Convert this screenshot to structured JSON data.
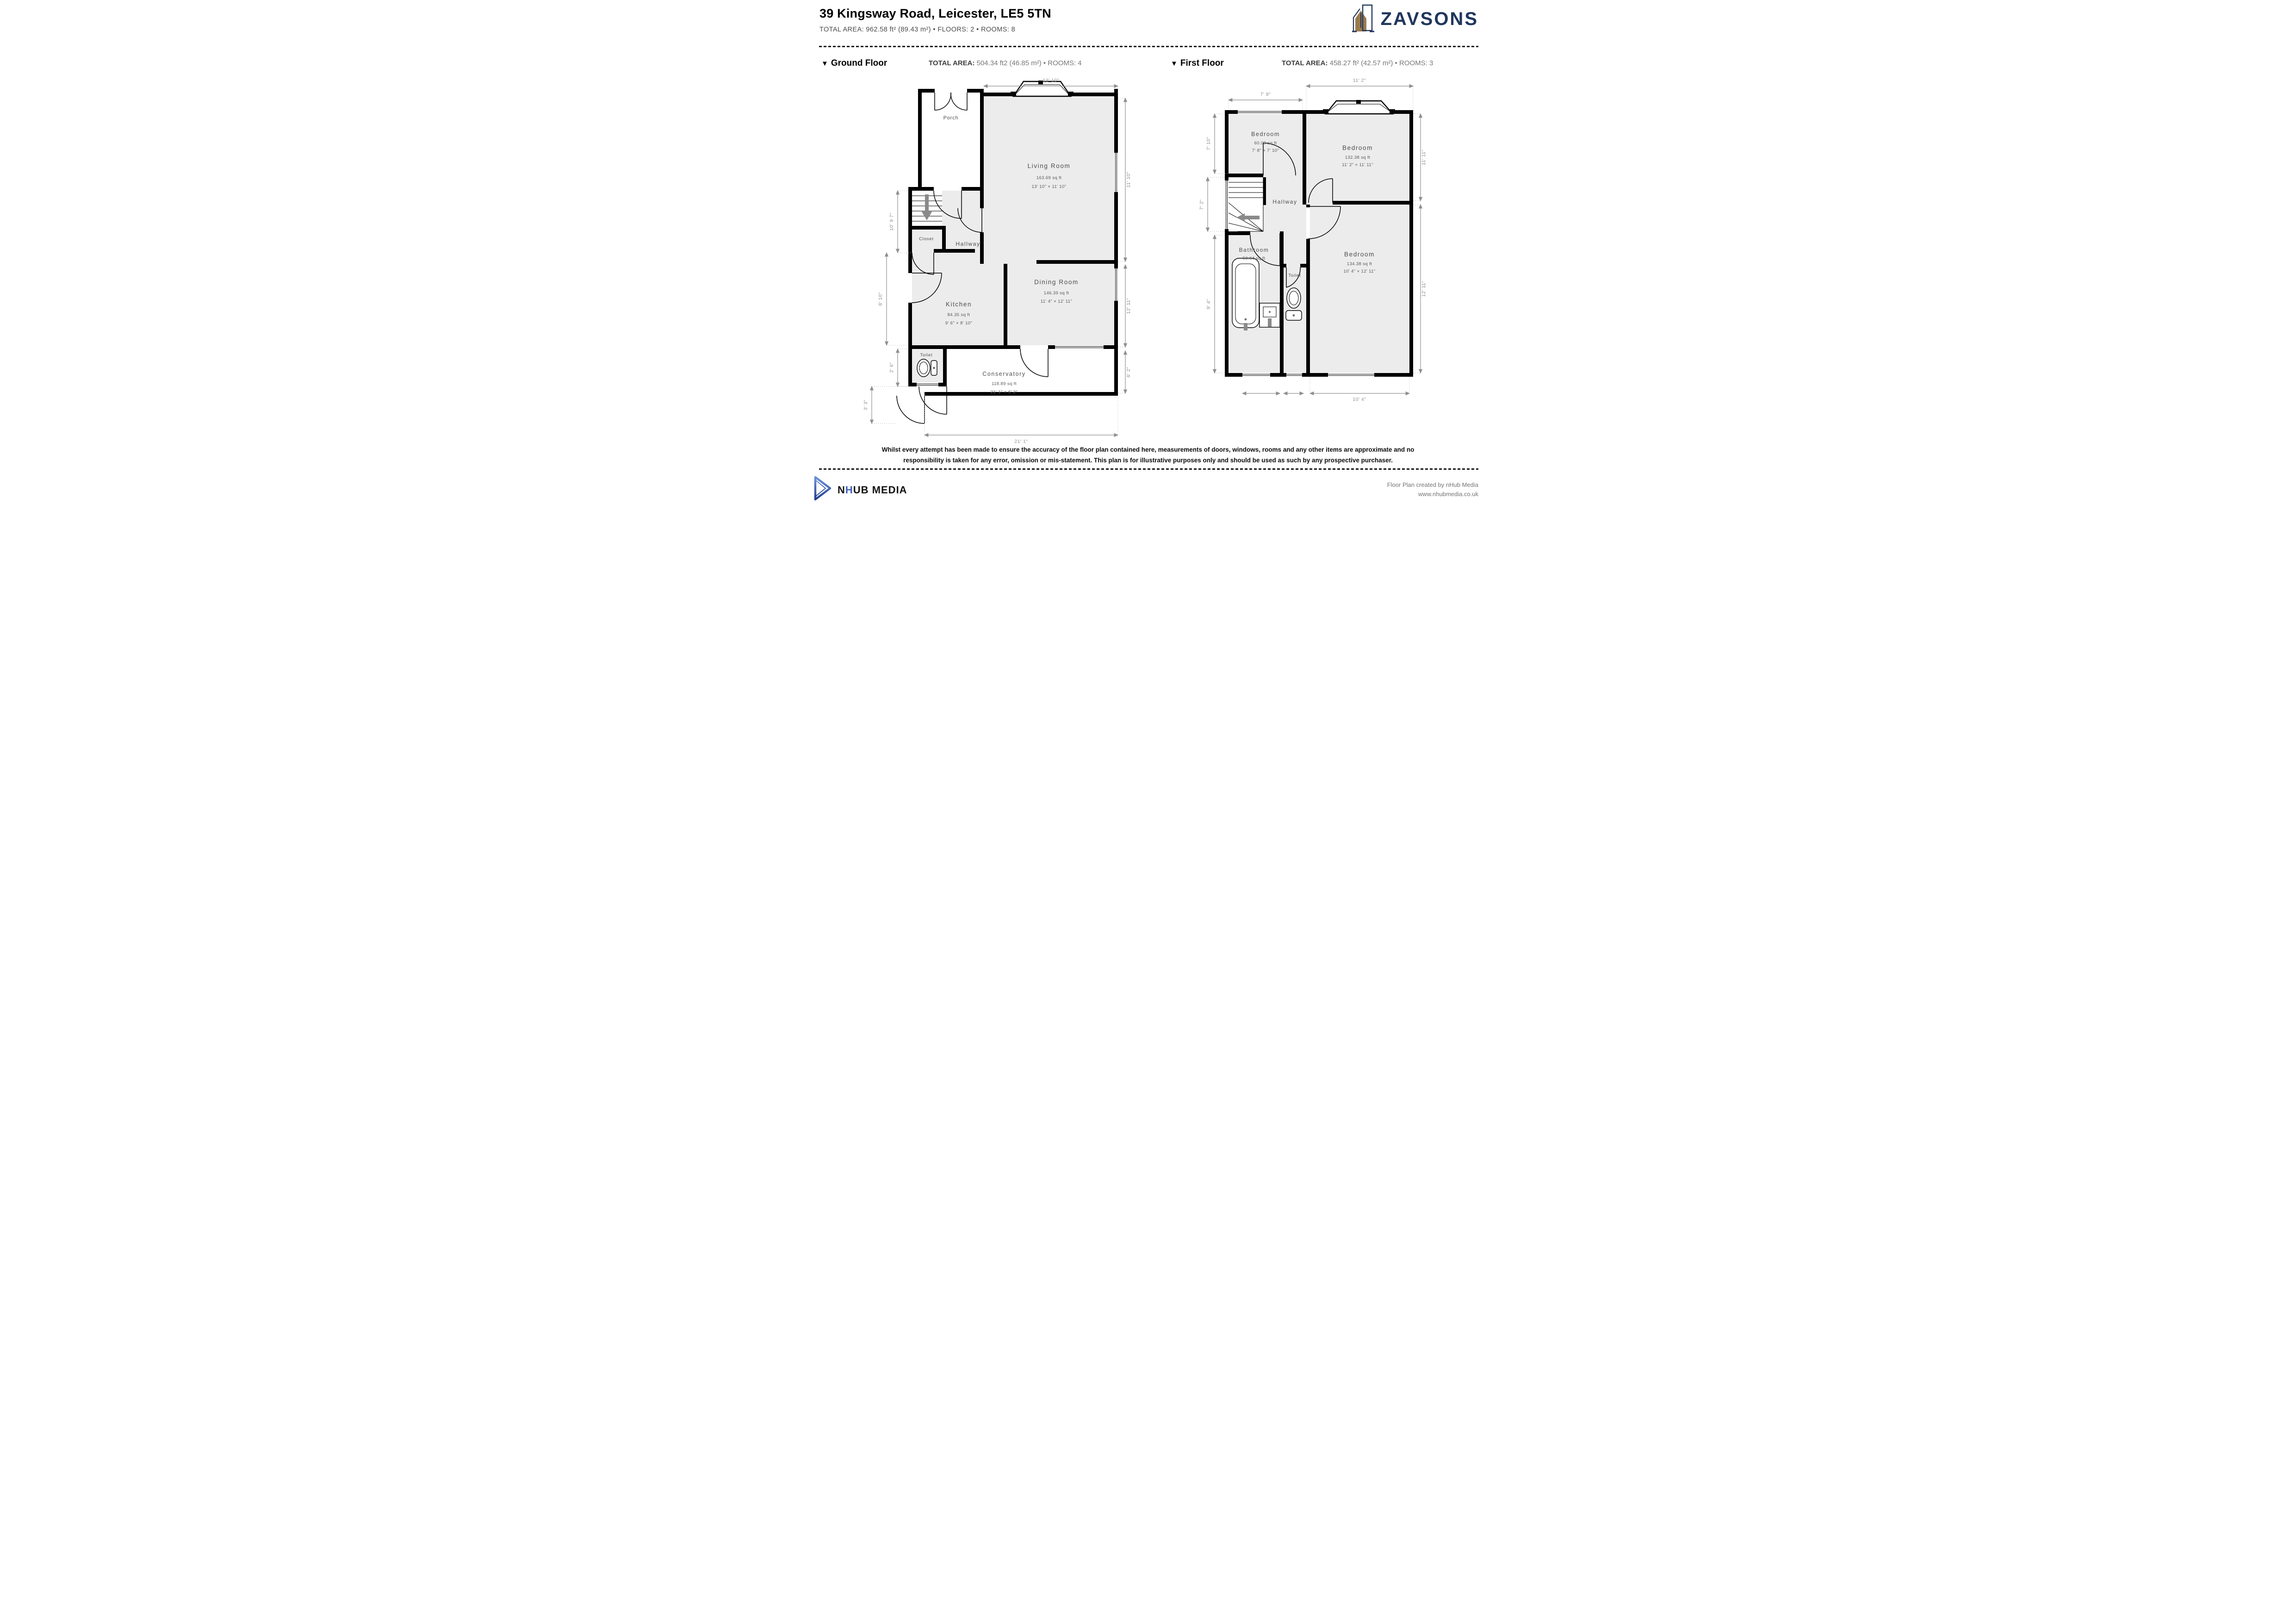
{
  "header": {
    "title": "39 Kingsway Road, Leicester, LE5 5TN",
    "subtitle": "TOTAL AREA: 962.58 ft² (89.43 m²) • FLOORS: 2 • ROOMS: 8",
    "brand": "ZAVSONS",
    "brand_navy": "#20365c",
    "brand_brown": "#9a7b4f"
  },
  "floors": [
    {
      "marker": "▼",
      "label": "Ground Floor",
      "total_label": "TOTAL AREA:",
      "total_value": "504.34 ft2 (46.85 m²) • ROOMS: 4",
      "rooms": {
        "porch": {
          "name": "Porch"
        },
        "living": {
          "name": "Living Room",
          "area": "163.69 sq ft",
          "dims": "13' 10\" × 11' 10\""
        },
        "hallway": {
          "name": "Hallway"
        },
        "closet": {
          "name": "Closet"
        },
        "kitchen": {
          "name": "Kitchen",
          "area": "84.35 sq ft",
          "dims": "9' 6\" × 8' 10\""
        },
        "dining": {
          "name": "Dining Room",
          "area": "146.39 sq ft",
          "dims": "11' 4\" × 12' 11\""
        },
        "toilet": {
          "name": "Toilet"
        },
        "conservatory": {
          "name": "Conservatory",
          "area": "118.89 sq ft",
          "dims": "21' 1\" × 6' 2\""
        }
      },
      "dims": {
        "top": "13' 10\"",
        "right_living": "11' 10\"",
        "right_dining": "12' 11\"",
        "right_conservatory": "6' 2\"",
        "left_stairs": "10' 9 7\"",
        "left_kitchen": "8' 10\"",
        "left_toilet": "2' 6\"",
        "left_steps": "3' 3\"",
        "bottom": "21' 1\""
      }
    },
    {
      "marker": "▼",
      "label": "First Floor",
      "total_label": "TOTAL AREA:",
      "total_value": "458.27 ft² (42.57 m²) • ROOMS: 3",
      "rooms": {
        "bedroom1": {
          "name": "Bedroom",
          "area": "60.09 sq ft",
          "dims": "7' 8\" × 7' 10\""
        },
        "bedroom2": {
          "name": "Bedroom",
          "area": "132.38 sq ft",
          "dims": "11' 2\" × 11' 11\""
        },
        "hallway": {
          "name": "Hallway"
        },
        "bathroom": {
          "name": "Bathroom",
          "area": "50.64 sq ft"
        },
        "toilet": {
          "name": "Toilet"
        },
        "bedroom3": {
          "name": "Bedroom",
          "area": "134.38 sq ft",
          "dims": "10' 4\" × 12' 11\""
        }
      },
      "dims": {
        "top_left": "7' 8\"",
        "top_right": "11' 2\"",
        "left_bedroom": "7' 10\"",
        "left_stairs": "7' 2\"",
        "left_bathroom": "9' 4\"",
        "right_top": "11' 11\"",
        "right_bottom": "12' 11\"",
        "bottom": "10' 4\""
      }
    }
  ],
  "disclaimer": {
    "line1": "Whilst every attempt has been made to ensure the accuracy of the floor plan contained here, measurements of doors, windows, rooms and any other items are approximate and no",
    "line2": "responsibility is taken for any error, omission or mis-statement. This plan is for illustrative purposes only and should be used as such by any prospective purchaser."
  },
  "footer": {
    "logo_n": "N",
    "logo_h": "H",
    "logo_ub": "UB",
    "logo_media": " MEDIA",
    "credit_line1": "Floor Plan created by nHub Media",
    "credit_line2": "www.nhubmedia.co.uk"
  }
}
